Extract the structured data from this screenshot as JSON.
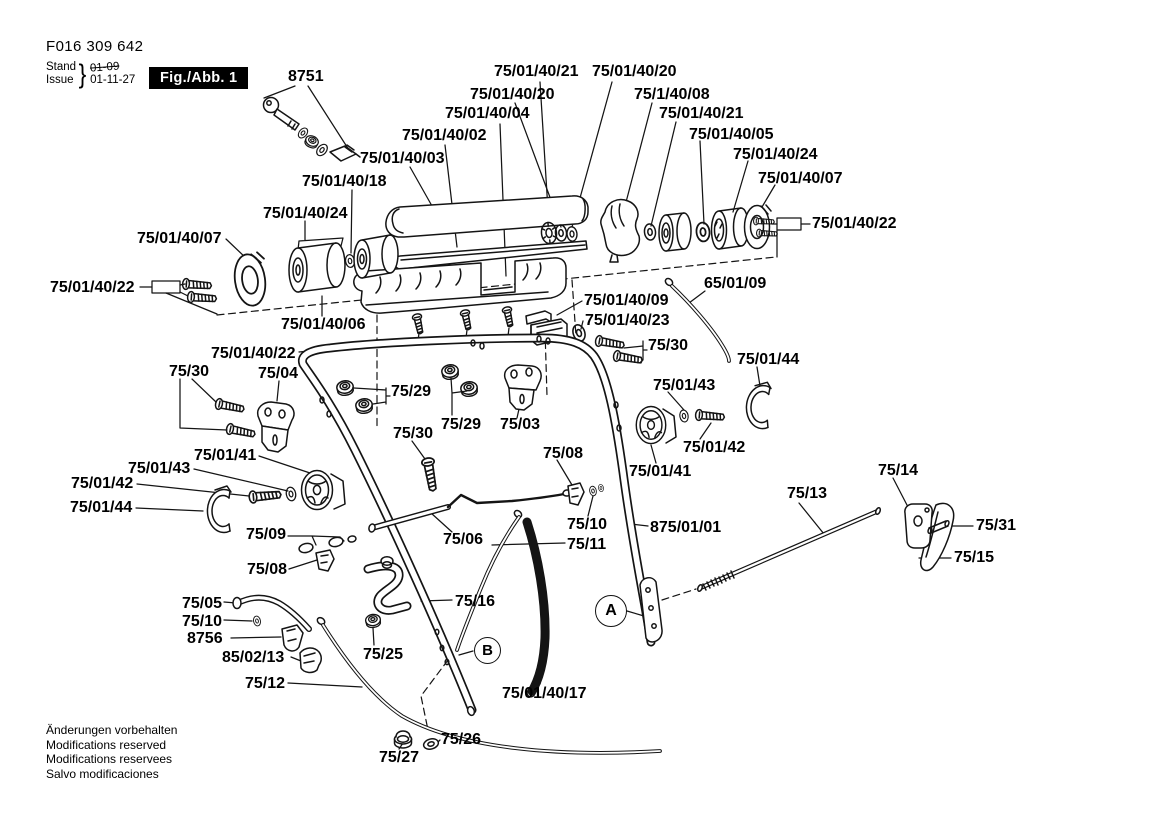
{
  "header": {
    "document_number": "F016 309 642",
    "stand_label": "Stand",
    "issue_label": "Issue",
    "brace": "}",
    "date_old": "01-09",
    "date_new": "01-11-27",
    "figure_badge": "Fig./Abb. 1"
  },
  "markers": {
    "a": "A",
    "b": "B"
  },
  "part_labels": {
    "p8751": "8751",
    "p75_01_40_21_a": "75/01/40/21",
    "p75_01_40_20_a": "75/01/40/20",
    "p75_01_40_20_b": "75/01/40/20",
    "p75_1_40_08": "75/1/40/08",
    "p75_01_40_04": "75/01/40/04",
    "p75_01_40_21_b": "75/01/40/21",
    "p75_01_40_02": "75/01/40/02",
    "p75_01_40_05": "75/01/40/05",
    "p75_01_40_03": "75/01/40/03",
    "p75_01_40_24_a": "75/01/40/24",
    "p75_01_40_18": "75/01/40/18",
    "p75_01_40_07_a": "75/01/40/07",
    "p75_01_40_24_b": "75/01/40/24",
    "p75_01_40_22_a": "75/01/40/22",
    "p75_01_40_07_b": "75/01/40/07",
    "p75_01_40_22_b": "75/01/40/22",
    "p65_01_09": "65/01/09",
    "p75_01_40_06": "75/01/40/06",
    "p75_01_40_09": "75/01/40/09",
    "p75_01_40_23": "75/01/40/23",
    "p75_01_40_22_c": "75/01/40/22",
    "p75_30_a": "75/30",
    "p75_01_44_a": "75/01/44",
    "p75_30_b": "75/30",
    "p75_04": "75/04",
    "p75_29_a": "75/29",
    "p75_01_43_a": "75/01/43",
    "p75_29_b": "75/29",
    "p75_03": "75/03",
    "p75_30_c": "75/30",
    "p75_01_42_a": "75/01/42",
    "p75_01_41_a": "75/01/41",
    "p75_01_41_b": "75/01/41",
    "p75_08_a": "75/08",
    "p75_01_43_b": "75/01/43",
    "p75_14": "75/14",
    "p75_01_42_b": "75/01/42",
    "p75_13": "75/13",
    "p75_01_44_b": "75/01/44",
    "p75_10_a": "75/10",
    "p875_01_01": "875/01/01",
    "p75_31": "75/31",
    "p75_09": "75/09",
    "p75_06": "75/06",
    "p75_11": "75/11",
    "p75_15": "75/15",
    "p75_08_b": "75/08",
    "p75_05": "75/05",
    "p75_10_b": "75/10",
    "p75_16": "75/16",
    "p8756": "8756",
    "p75_25": "75/25",
    "p85_02_13": "85/02/13",
    "p75_12": "75/12",
    "p75_01_40_17": "75/01/40/17",
    "p75_26": "75/26",
    "p75_27": "75/27"
  },
  "footer": {
    "line1": "Änderungen vorbehalten",
    "line2": "Modifications reserved",
    "line3": "Modifications reservees",
    "line4": "Salvo modificaciones"
  }
}
